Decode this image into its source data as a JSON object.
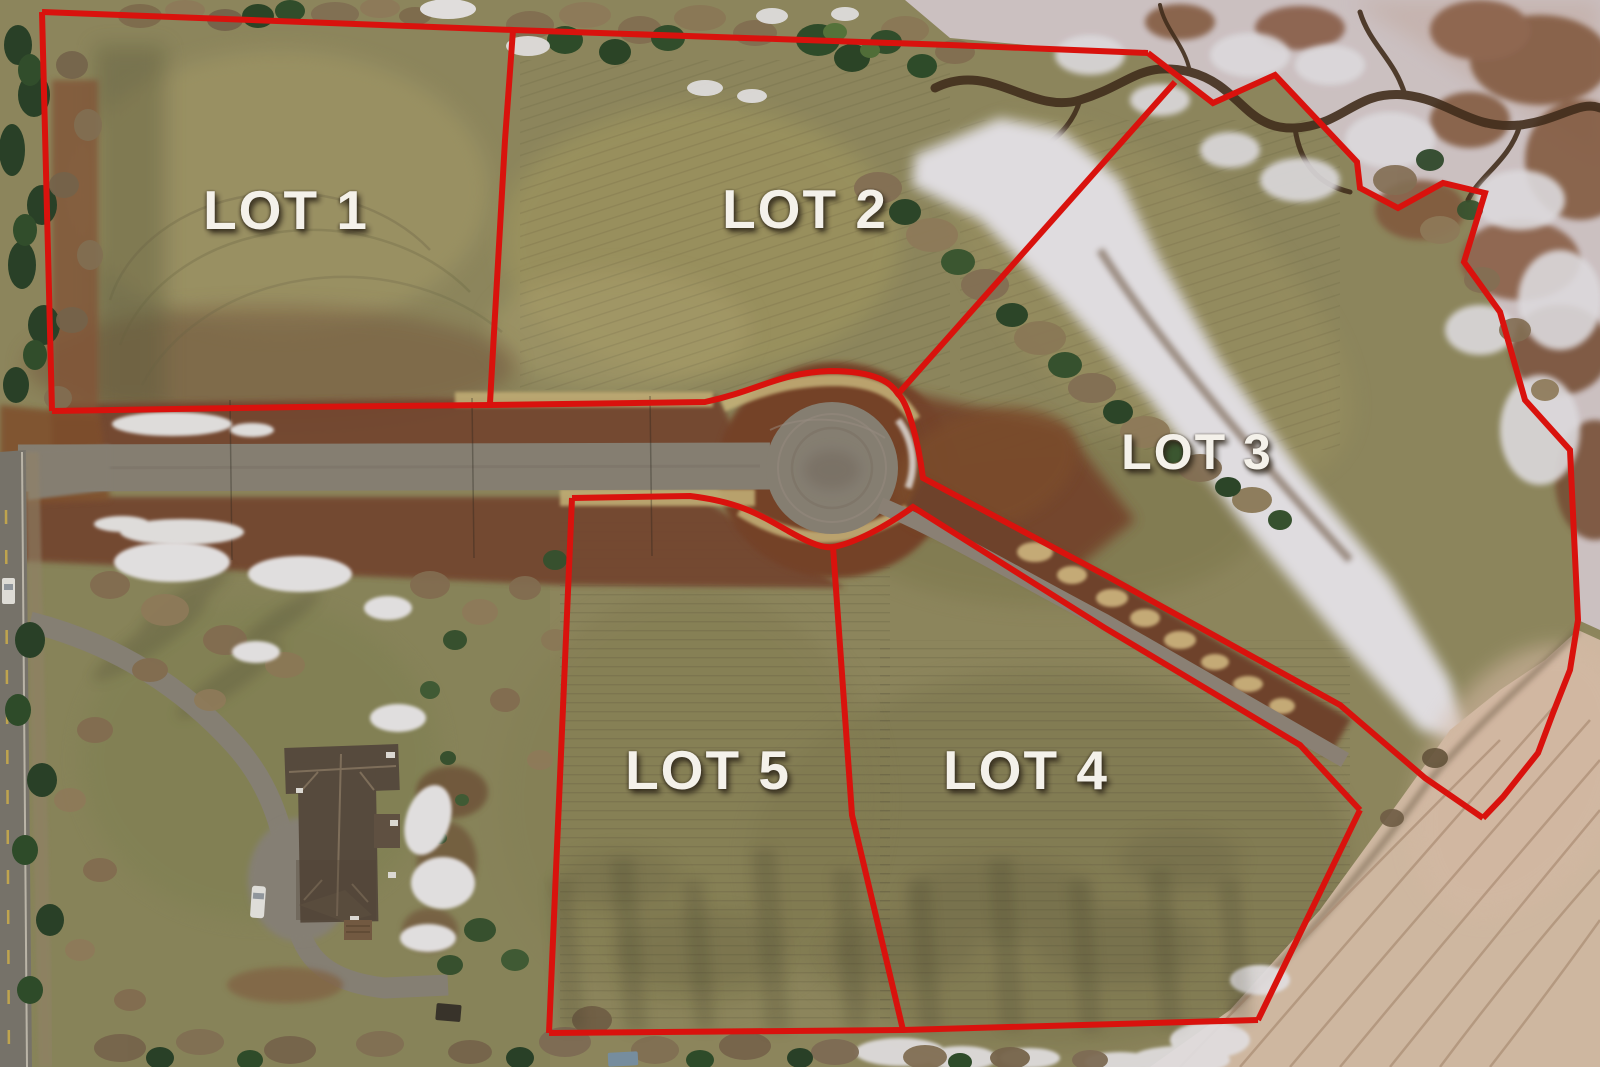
{
  "map": {
    "title": "Aerial subdivision lot map with red boundary overlay",
    "lots": [
      {
        "id": "lot-1",
        "label": "LOT 1"
      },
      {
        "id": "lot-2",
        "label": "LOT 2"
      },
      {
        "id": "lot-3",
        "label": "LOT 3"
      },
      {
        "id": "lot-4",
        "label": "LOT 4"
      },
      {
        "id": "lot-5",
        "label": "LOT 5"
      }
    ],
    "colors": {
      "boundary_red": "#e8140e",
      "label_white": "#f4f1ea",
      "field_olive": "#958e62",
      "disturbed_soil_brown": "#7a4a30",
      "pavement_gray": "#8e8679",
      "dead_grass_tan": "#ccb87c",
      "snow_white": "#edeaed",
      "marsh_ice": "#d8cccd",
      "beach_sand": "#dbc3ab",
      "conifer_green": "#2f4a2b",
      "bare_tree_brown": "#8b7557"
    }
  }
}
